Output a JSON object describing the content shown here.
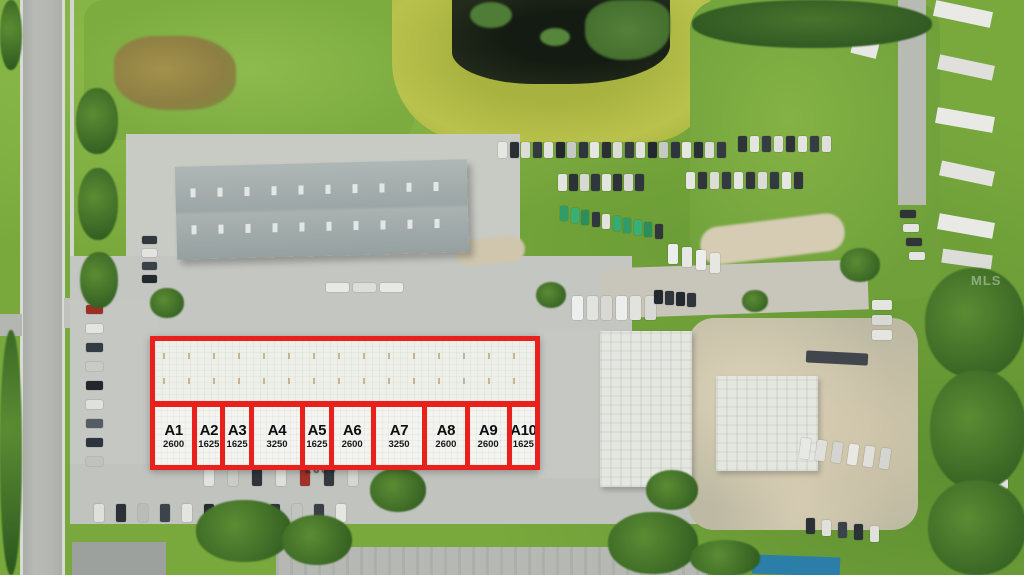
{
  "image": {
    "type": "aerial-drone-photo-of-commercial-property",
    "watermark_text": "MLS"
  },
  "overlay": {
    "accent_color": "#E8211D",
    "units": [
      {
        "label": "A1",
        "sqft": 2600
      },
      {
        "label": "A2",
        "sqft": 1625
      },
      {
        "label": "A3",
        "sqft": 1625
      },
      {
        "label": "A4",
        "sqft": 3250
      },
      {
        "label": "A5",
        "sqft": 1625
      },
      {
        "label": "A6",
        "sqft": 2600
      },
      {
        "label": "A7",
        "sqft": 3250
      },
      {
        "label": "A8",
        "sqft": 2600
      },
      {
        "label": "A9",
        "sqft": 2600
      },
      {
        "label": "A10",
        "sqft": 1625
      }
    ],
    "stray_label": "2600"
  }
}
